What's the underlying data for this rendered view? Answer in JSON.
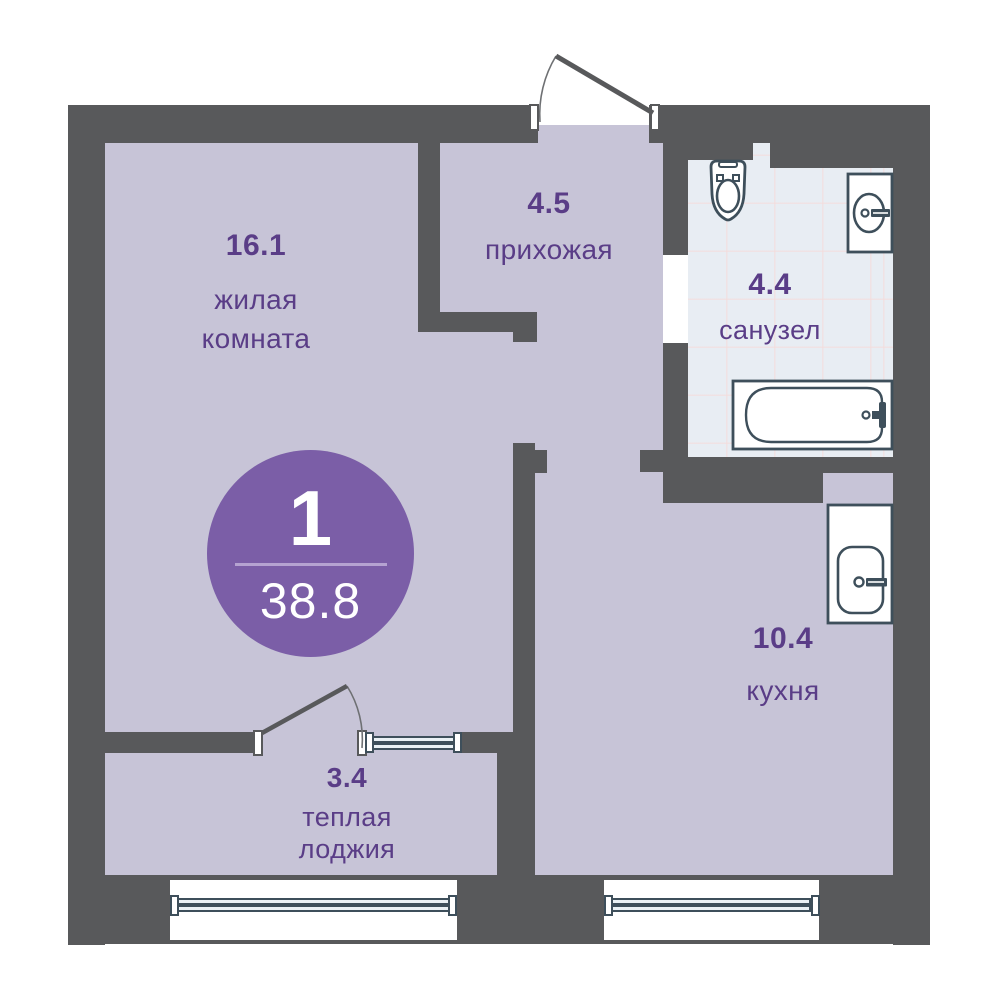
{
  "badge": {
    "rooms_count": "1",
    "total_area": "38.8"
  },
  "rooms": {
    "living": {
      "area": "16.1",
      "name_line1": "жилая",
      "name_line2": "комната"
    },
    "hallway": {
      "area": "4.5",
      "name_line1": "прихожая"
    },
    "bathroom": {
      "area": "4.4",
      "name_line1": "санузел"
    },
    "kitchen": {
      "area": "10.4",
      "name_line1": "кухня"
    },
    "loggia": {
      "area": "3.4",
      "name_line1": "теплая",
      "name_line2": "лоджия"
    }
  },
  "icons": {
    "toilet": "toilet-icon",
    "bathroom_sink": "sink-icon",
    "bathtub": "bathtub-icon",
    "kitchen_sink": "kitchen-sink-icon",
    "entrance_door": "door-swing-icon",
    "loggia_door": "door-swing-icon",
    "windows": "window-symbol"
  },
  "colors": {
    "wall": "#58595b",
    "room_fill": "#c7c4d7",
    "tile_fill": "#e8edf3",
    "badge_accent": "#7b5ea7",
    "badge_divider": "#b5a3d1",
    "label_text": "#5a3d87",
    "fixture_outline": "#3e4f5b",
    "background": "#ffffff"
  }
}
